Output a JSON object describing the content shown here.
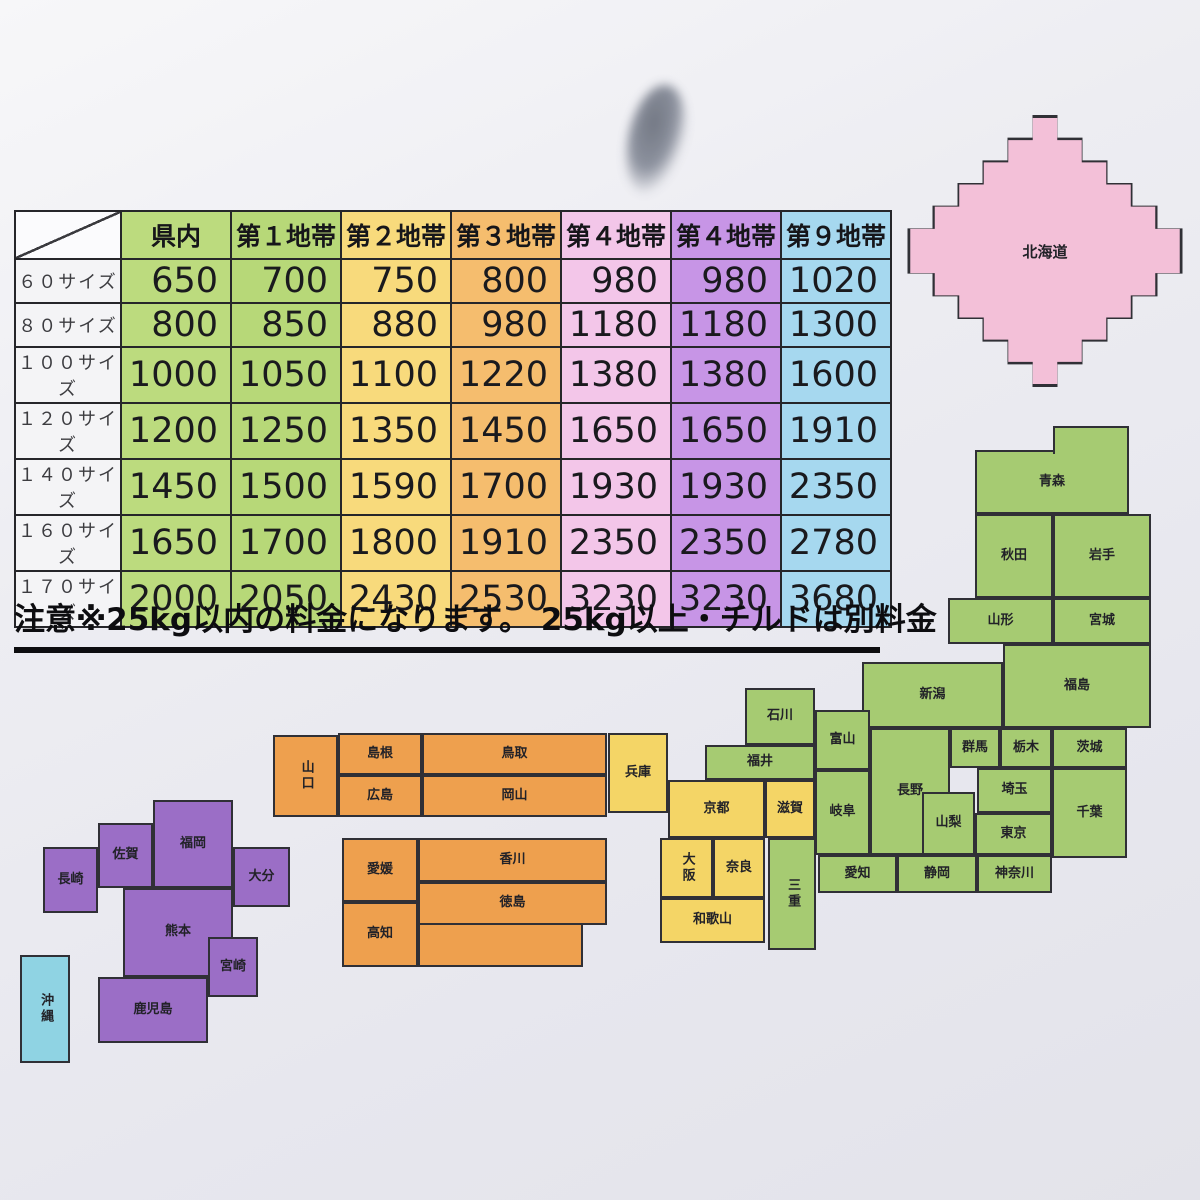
{
  "rate_table": {
    "columns": [
      {
        "label": "県内",
        "color": "#bcdb7e"
      },
      {
        "label": "第１地帯",
        "color": "#b7d878"
      },
      {
        "label": "第２地帯",
        "color": "#f8da7c"
      },
      {
        "label": "第３地帯",
        "color": "#f5bd6e"
      },
      {
        "label": "第４地帯",
        "color": "#f3c6e9"
      },
      {
        "label": "第４地帯",
        "color": "#c795e6"
      },
      {
        "label": "第９地帯",
        "color": "#a6d8ef"
      }
    ],
    "rows": [
      {
        "label": "６０サイズ",
        "values": [
          "650",
          "700",
          "750",
          "800",
          "980",
          "980",
          "1020"
        ]
      },
      {
        "label": "８０サイズ",
        "values": [
          "800",
          "850",
          "880",
          "980",
          "1180",
          "1180",
          "1300"
        ]
      },
      {
        "label": "１００サイズ",
        "values": [
          "1000",
          "1050",
          "1100",
          "1220",
          "1380",
          "1380",
          "1600"
        ]
      },
      {
        "label": "１２０サイズ",
        "values": [
          "1200",
          "1250",
          "1350",
          "1450",
          "1650",
          "1650",
          "1910"
        ]
      },
      {
        "label": "１４０サイズ",
        "values": [
          "1450",
          "1500",
          "1590",
          "1700",
          "1930",
          "1930",
          "2350"
        ]
      },
      {
        "label": "１６０サイズ",
        "values": [
          "1650",
          "1700",
          "1800",
          "1910",
          "2350",
          "2350",
          "2780"
        ]
      },
      {
        "label": "１７０サイズ",
        "values": [
          "2000",
          "2050",
          "2430",
          "2530",
          "3230",
          "3230",
          "3680"
        ]
      }
    ]
  },
  "note": {
    "text": "注意※25kg以内の料金になります。 25kg以上・チルドは別料金"
  },
  "map": {
    "zone_colors": {
      "pink": "#f3c0d8",
      "green": "#a6cb72",
      "yellow": "#f4d566",
      "orange": "#eea04e",
      "purple": "#9b6ec6",
      "blue": "#8fd3e3"
    },
    "prefectures": [
      {
        "name": "北海道",
        "zone": "pink"
      },
      {
        "name": "青森",
        "zone": "green"
      },
      {
        "name": "秋田",
        "zone": "green"
      },
      {
        "name": "岩手",
        "zone": "green"
      },
      {
        "name": "山形",
        "zone": "green"
      },
      {
        "name": "宮城",
        "zone": "green"
      },
      {
        "name": "福島",
        "zone": "green"
      },
      {
        "name": "新潟",
        "zone": "green"
      },
      {
        "name": "石川",
        "zone": "green"
      },
      {
        "name": "富山",
        "zone": "green"
      },
      {
        "name": "福井",
        "zone": "green"
      },
      {
        "name": "長野",
        "zone": "green"
      },
      {
        "name": "群馬",
        "zone": "green"
      },
      {
        "name": "栃木",
        "zone": "green"
      },
      {
        "name": "茨城",
        "zone": "green"
      },
      {
        "name": "埼玉",
        "zone": "green"
      },
      {
        "name": "千葉",
        "zone": "green"
      },
      {
        "name": "山梨",
        "zone": "green"
      },
      {
        "name": "東京",
        "zone": "green"
      },
      {
        "name": "神奈川",
        "zone": "green"
      },
      {
        "name": "静岡",
        "zone": "green"
      },
      {
        "name": "愛知",
        "zone": "green"
      },
      {
        "name": "岐阜",
        "zone": "green"
      },
      {
        "name": "三重",
        "zone": "green"
      },
      {
        "name": "滋賀",
        "zone": "yellow"
      },
      {
        "name": "京都",
        "zone": "yellow"
      },
      {
        "name": "兵庫",
        "zone": "yellow"
      },
      {
        "name": "大阪",
        "zone": "yellow"
      },
      {
        "name": "奈良",
        "zone": "yellow"
      },
      {
        "name": "和歌山",
        "zone": "yellow"
      },
      {
        "name": "鳥取",
        "zone": "orange"
      },
      {
        "name": "島根",
        "zone": "orange"
      },
      {
        "name": "岡山",
        "zone": "orange"
      },
      {
        "name": "広島",
        "zone": "orange"
      },
      {
        "name": "山口",
        "zone": "orange"
      },
      {
        "name": "香川",
        "zone": "orange"
      },
      {
        "name": "徳島",
        "zone": "orange"
      },
      {
        "name": "愛媛",
        "zone": "orange"
      },
      {
        "name": "高知",
        "zone": "orange"
      },
      {
        "name": "福岡",
        "zone": "purple"
      },
      {
        "name": "佐賀",
        "zone": "purple"
      },
      {
        "name": "長崎",
        "zone": "purple"
      },
      {
        "name": "大分",
        "zone": "purple"
      },
      {
        "name": "熊本",
        "zone": "purple"
      },
      {
        "name": "宮崎",
        "zone": "purple"
      },
      {
        "name": "鹿児島",
        "zone": "purple"
      },
      {
        "name": "沖縄",
        "zone": "blue"
      }
    ]
  }
}
